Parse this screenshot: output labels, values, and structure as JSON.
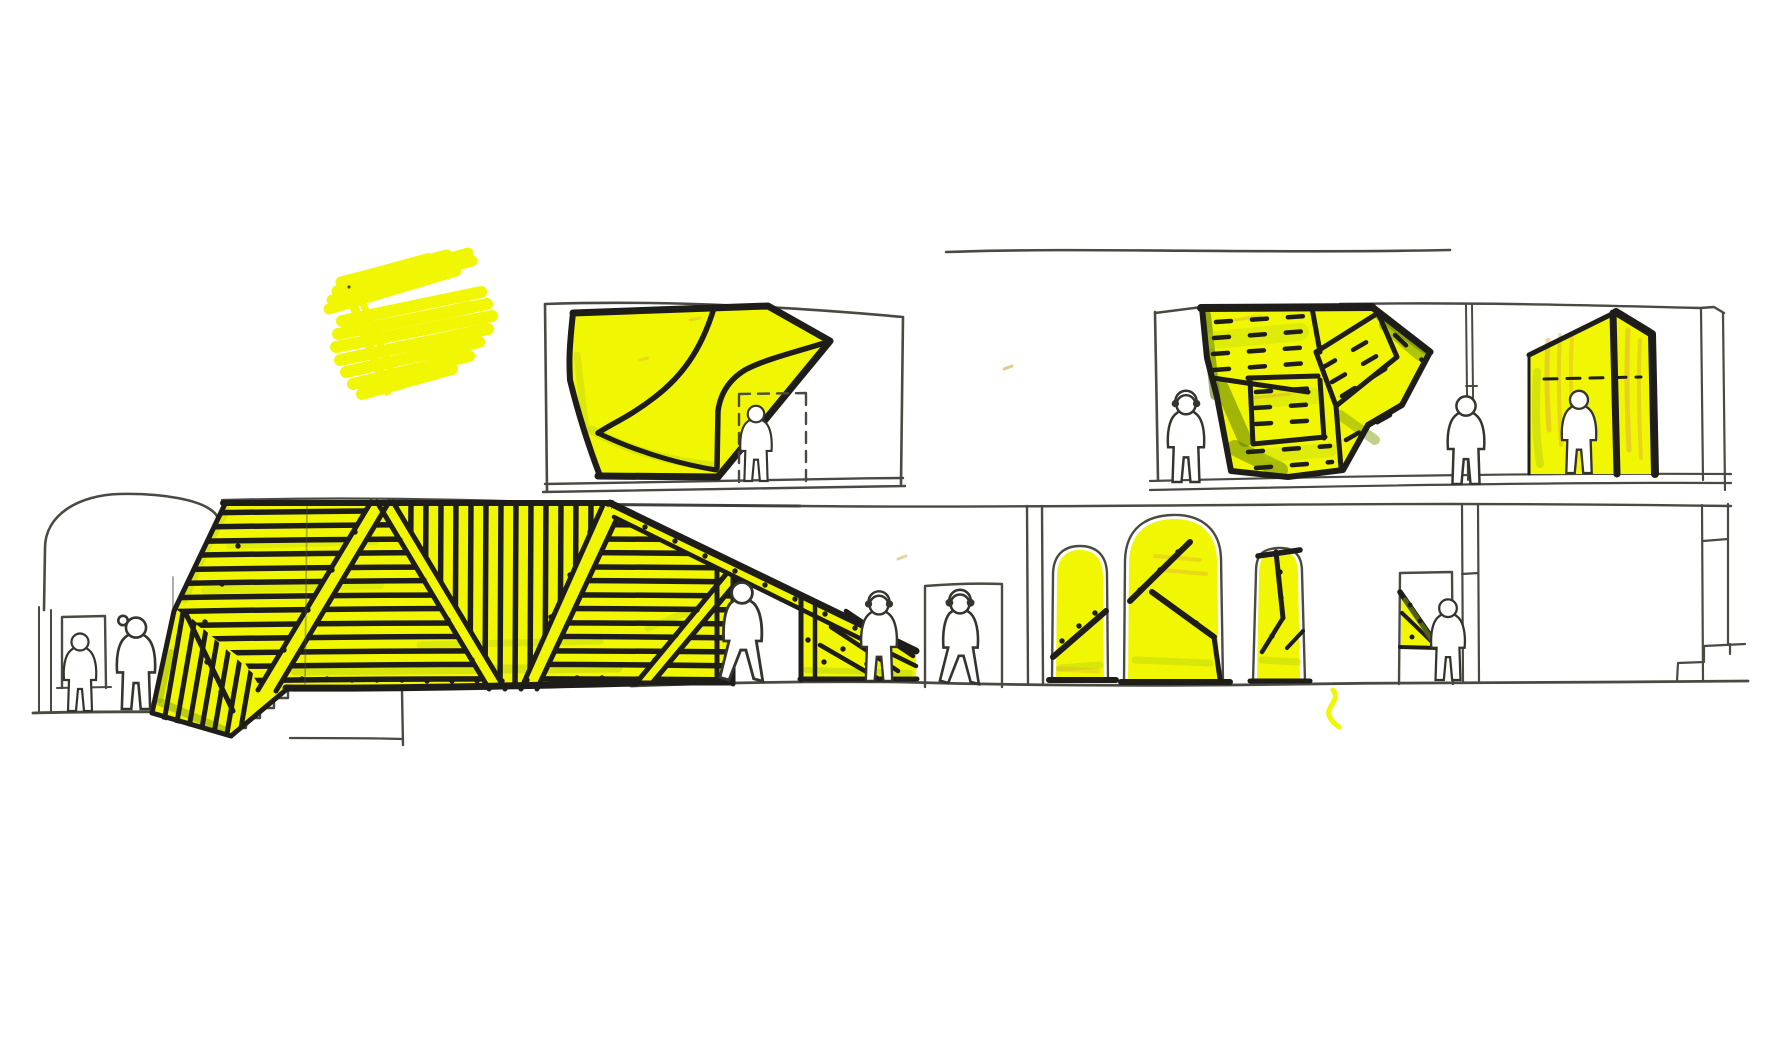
{
  "meta": {
    "title": "Hand-drawn architectural section sketch with yellow marker pavilions and small visitor figures",
    "medium": "ink and highlighter marker on white paper",
    "floors": 2
  },
  "colors": {
    "paper": "#ffffff",
    "ink": "#1e1d1a",
    "line": "#4a4942",
    "figure": "#35342e",
    "yellow": "#f1f603",
    "yellowgreen": "#b5cf15",
    "green": "#86a40f",
    "darkgreen": "#5e7d0c",
    "orange": "#d9a440"
  },
  "scene": {
    "sun_scribble": {
      "label": "yellow marker scribble cluster, top left",
      "clusters": 2
    },
    "upper_left_vitrine": {
      "label": "boxed upper room with faceted yellow canopy volume, dashed doorway and visitor"
    },
    "upper_gallery": {
      "label": "second-floor gallery with patchwork yellow panel canopy and two visitors"
    },
    "upper_annex": {
      "label": "second-floor annex with yellow hut enclosure and visitor inside"
    },
    "ground_canopy": {
      "label": "ground-floor striped yellow tent canopy with trusses, rivets and stairs"
    },
    "left_room": {
      "label": "vaulted left room with doorway and two visitors"
    },
    "center_doorway": {
      "label": "central doorway with standing visitor"
    },
    "arcade": {
      "label": "arcade wall with three yellow-infilled arched openings and strap braces"
    },
    "right_doorway": {
      "label": "right doorway with small yellow wedge and visitor"
    },
    "right_stair": {
      "label": "stair at far right wall"
    },
    "ground_squiggle": {
      "label": "small yellow marker squiggle on the ground line"
    }
  },
  "figures": {
    "count": 10,
    "items": [
      {
        "name": "visitor-left-room-doorway"
      },
      {
        "name": "visitor-left-room-ponytail"
      },
      {
        "name": "visitor-walking-under-canopy"
      },
      {
        "name": "visitor-headphones-by-canopy-tail"
      },
      {
        "name": "visitor-center-doorway"
      },
      {
        "name": "visitor-gallery-left"
      },
      {
        "name": "visitor-gallery-right"
      },
      {
        "name": "visitor-inside-hut"
      },
      {
        "name": "visitor-right-doorway"
      },
      {
        "name": "visitor-upper-vitrine"
      }
    ]
  }
}
